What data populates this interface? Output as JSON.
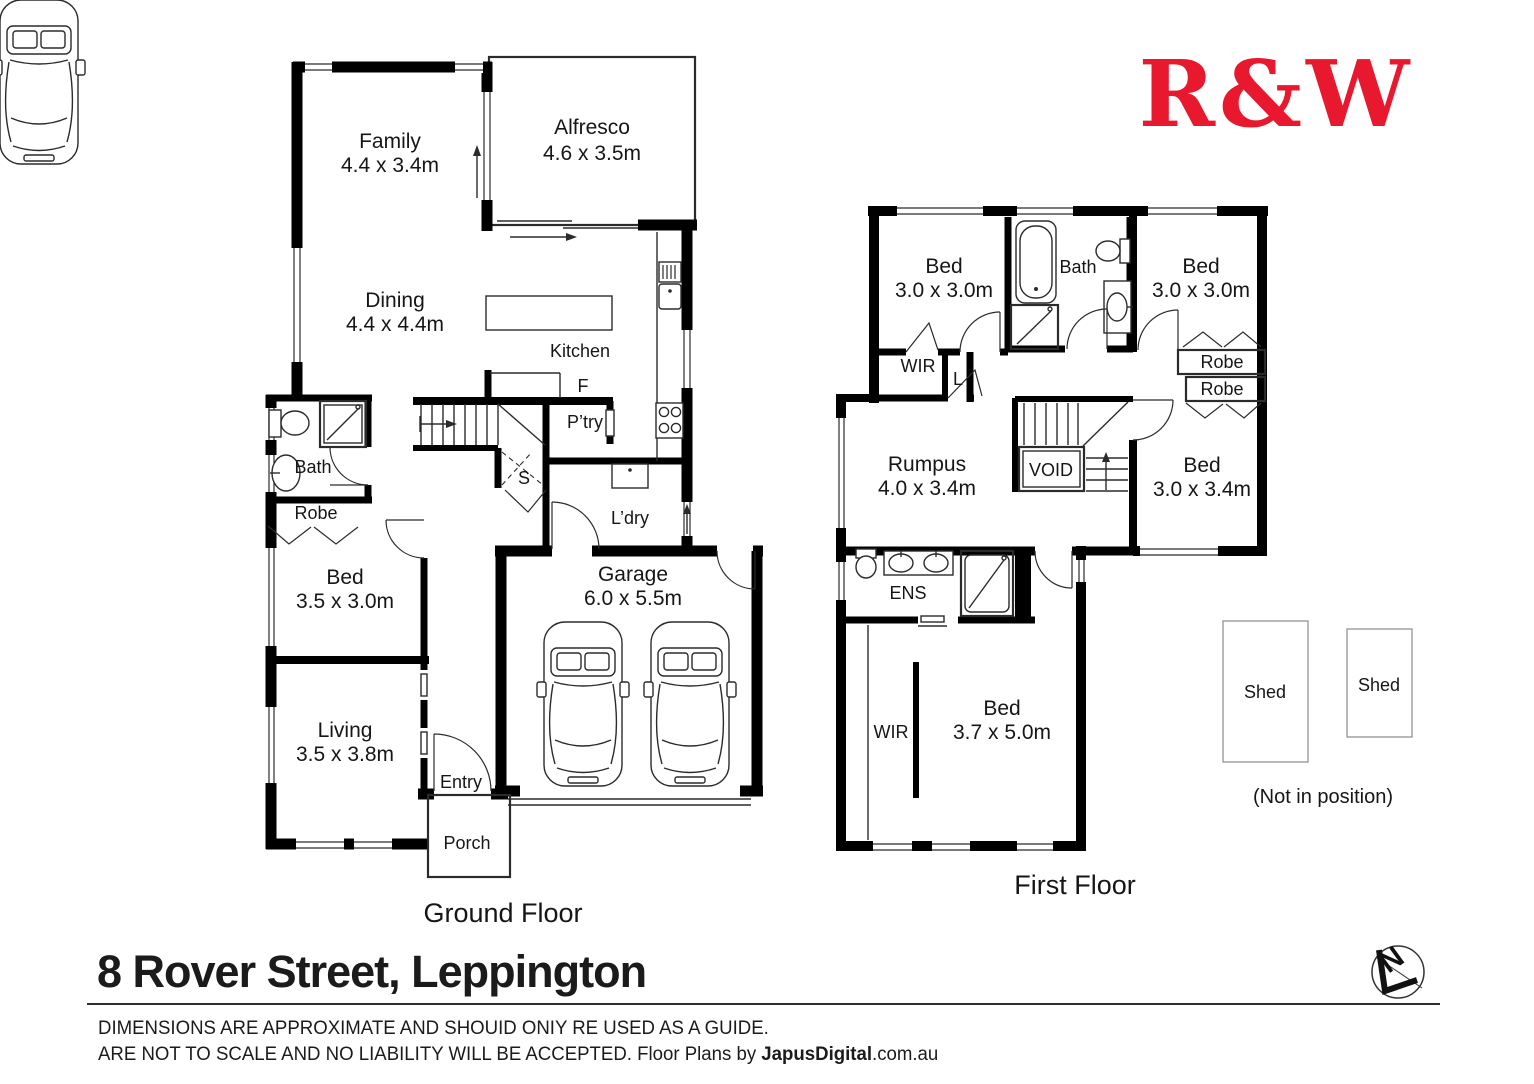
{
  "brand": {
    "logo_text": "R&W"
  },
  "address": {
    "title": "8 Rover Street, Leppington"
  },
  "footer": {
    "disclaimer_line1": "DIMENSIONS ARE APPROXIMATE AND SHOUID ONIY RE USED AS A GUIDE.",
    "disclaimer_line2": "ARE NOT TO SCALE AND NO LIABILITY WILL BE ACCEPTED. Floor Plans by ",
    "brand_name": "JapusDigital",
    "brand_suffix": ".com.au"
  },
  "colors": {
    "brand_red": "#E8182E",
    "wall": "#000000"
  },
  "ground_floor": {
    "label": "Ground Floor",
    "rooms": {
      "family": {
        "name": "Family",
        "dims": "4.4 x 3.4m"
      },
      "alfresco": {
        "name": "Alfresco",
        "dims": "4.6 x 3.5m"
      },
      "dining": {
        "name": "Dining",
        "dims": "4.4 x 4.4m"
      },
      "kitchen": {
        "name": "Kitchen"
      },
      "fridge": {
        "name": "F"
      },
      "pantry": {
        "name": "P’try"
      },
      "store": {
        "name": "S"
      },
      "bath": {
        "name": "Bath"
      },
      "robe": {
        "name": "Robe"
      },
      "bed": {
        "name": "Bed",
        "dims": "3.5 x 3.0m"
      },
      "living": {
        "name": "Living",
        "dims": "3.5 x 3.8m"
      },
      "laundry": {
        "name": "L’dry"
      },
      "garage": {
        "name": "Garage",
        "dims": "6.0 x 5.5m"
      },
      "entry": {
        "name": "Entry"
      },
      "porch": {
        "name": "Porch"
      }
    }
  },
  "first_floor": {
    "label": "First Floor",
    "rooms": {
      "bed1": {
        "name": "Bed",
        "dims": "3.0 x 3.0m"
      },
      "bath": {
        "name": "Bath"
      },
      "bed2": {
        "name": "Bed",
        "dims": "3.0 x 3.0m"
      },
      "wir": {
        "name": "WIR"
      },
      "linen": {
        "name": "L"
      },
      "robe1": {
        "name": "Robe"
      },
      "robe2": {
        "name": "Robe"
      },
      "rumpus": {
        "name": "Rumpus",
        "dims": "4.0 x 3.4m"
      },
      "void": {
        "name": "VOID"
      },
      "bed3": {
        "name": "Bed",
        "dims": "3.0 x 3.4m"
      },
      "ens": {
        "name": "ENS"
      },
      "wir2": {
        "name": "WIR"
      },
      "bed4": {
        "name": "Bed",
        "dims": "3.7 x 5.0m"
      }
    }
  },
  "outbuildings": {
    "shed1": "Shed",
    "shed2": "Shed",
    "note": "(Not in position)"
  },
  "compass": {
    "north": "N"
  }
}
